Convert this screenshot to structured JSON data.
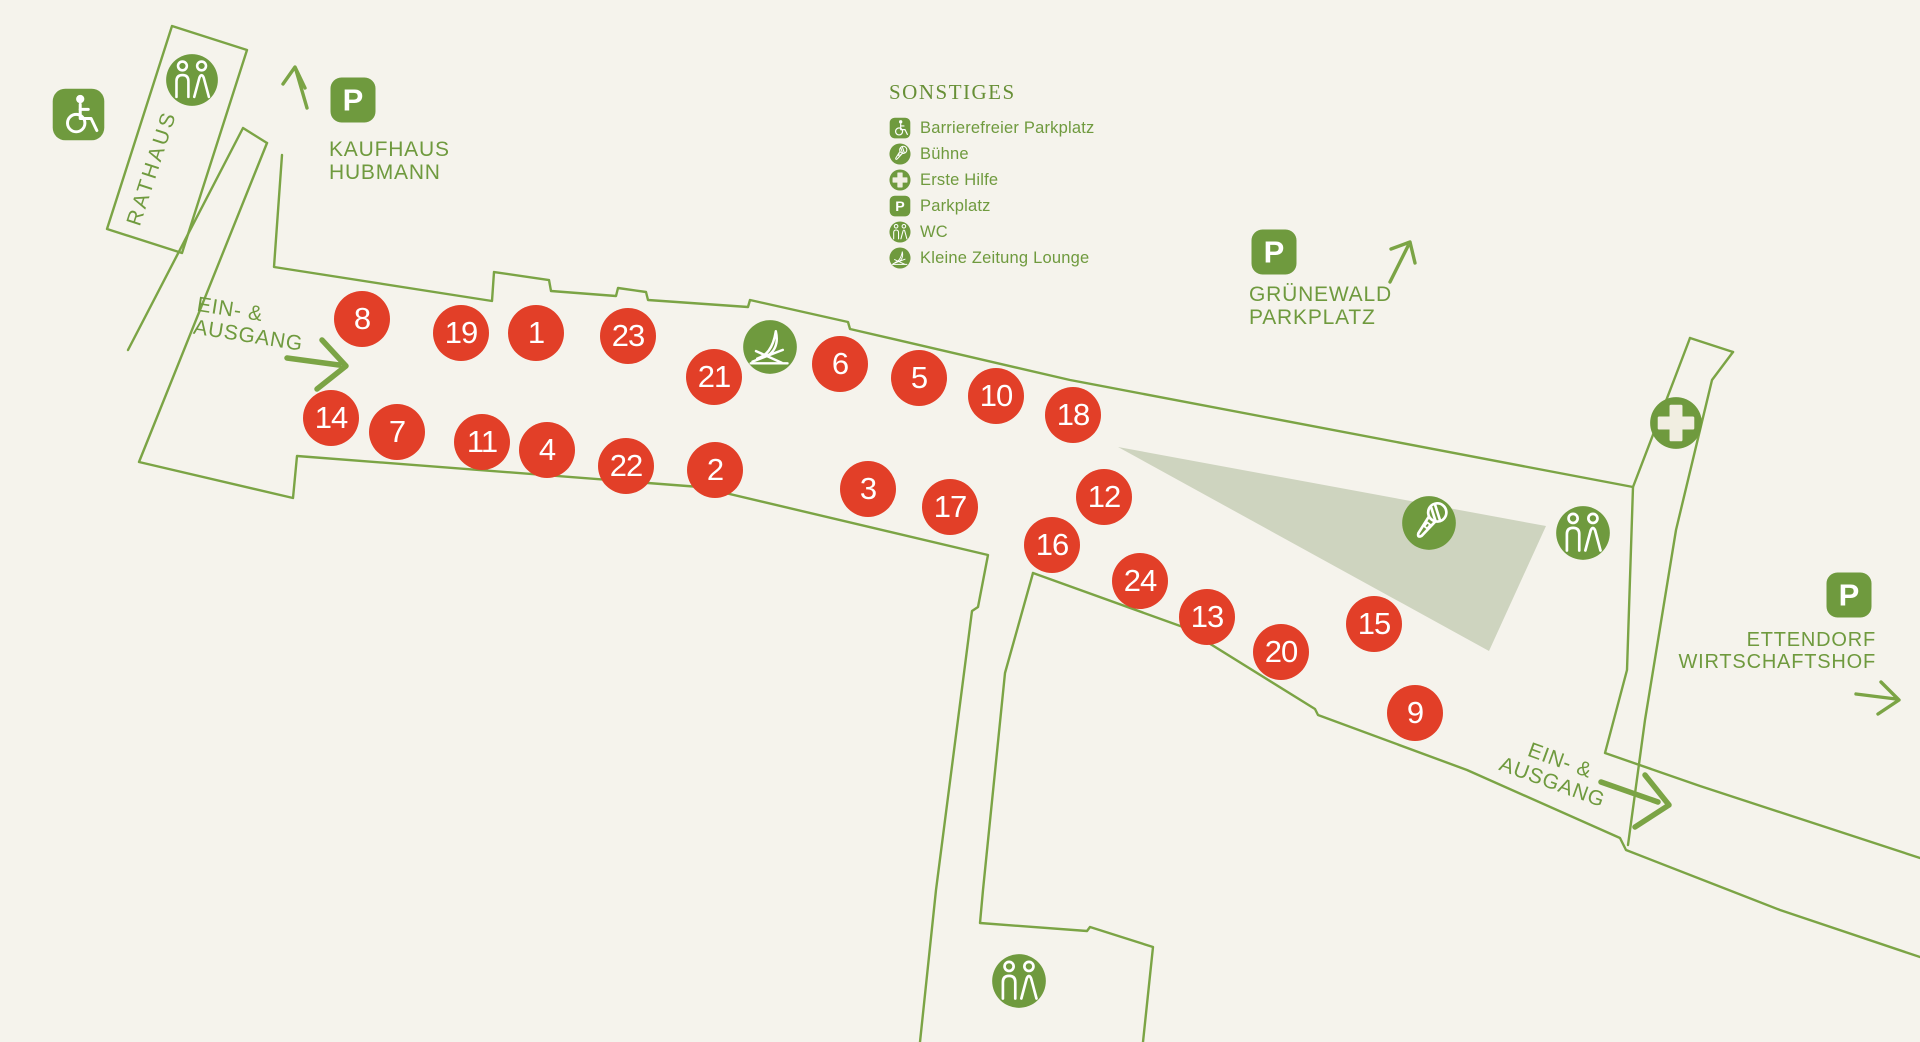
{
  "legend": {
    "title": "SONSTIGES",
    "items": [
      {
        "icon": "wheelchair",
        "label": "Barrierefreier Parkplatz"
      },
      {
        "icon": "mic",
        "label": "Bühne"
      },
      {
        "icon": "firstaid",
        "label": "Erste Hilfe"
      },
      {
        "icon": "parking",
        "label": "Parkplatz"
      },
      {
        "icon": "wc",
        "label": "WC"
      },
      {
        "icon": "lounge",
        "label": "Kleine Zeitung Lounge"
      }
    ]
  },
  "labels": {
    "rathaus": "RATHAUS",
    "kaufhaus_line1": "KAUFHAUS",
    "kaufhaus_line2": "HUBMANN",
    "gruenewald_line1": "GRÜNEWALD",
    "gruenewald_line2": "PARKPLATZ",
    "ettendorf_line1": "ETTENDORF",
    "ettendorf_line2": "WIRTSCHAFTSHOF",
    "entrance_west_line1": "EIN- &",
    "entrance_west_line2": "AUSGANG",
    "entrance_east_line1": "EIN- &",
    "entrance_east_line2": "AUSGANG"
  },
  "stalls": [
    {
      "number": "8",
      "x": 362,
      "y": 319
    },
    {
      "number": "19",
      "x": 461,
      "y": 333
    },
    {
      "number": "1",
      "x": 536,
      "y": 333
    },
    {
      "number": "23",
      "x": 628,
      "y": 336
    },
    {
      "number": "21",
      "x": 714,
      "y": 377
    },
    {
      "number": "6",
      "x": 840,
      "y": 364
    },
    {
      "number": "5",
      "x": 919,
      "y": 378
    },
    {
      "number": "10",
      "x": 996,
      "y": 396
    },
    {
      "number": "18",
      "x": 1073,
      "y": 415
    },
    {
      "number": "14",
      "x": 331,
      "y": 418
    },
    {
      "number": "7",
      "x": 397,
      "y": 432
    },
    {
      "number": "11",
      "x": 482,
      "y": 442
    },
    {
      "number": "4",
      "x": 547,
      "y": 450
    },
    {
      "number": "22",
      "x": 626,
      "y": 466
    },
    {
      "number": "2",
      "x": 715,
      "y": 470
    },
    {
      "number": "3",
      "x": 868,
      "y": 489
    },
    {
      "number": "17",
      "x": 950,
      "y": 507
    },
    {
      "number": "12",
      "x": 1104,
      "y": 497
    },
    {
      "number": "16",
      "x": 1052,
      "y": 545
    },
    {
      "number": "24",
      "x": 1140,
      "y": 581
    },
    {
      "number": "13",
      "x": 1207,
      "y": 617
    },
    {
      "number": "20",
      "x": 1281,
      "y": 652
    },
    {
      "number": "15",
      "x": 1374,
      "y": 624
    },
    {
      "number": "9",
      "x": 1415,
      "y": 713
    }
  ],
  "map_icons": [
    {
      "icon": "wheelchair",
      "x": 78,
      "y": 114,
      "size": 55,
      "shape": "square"
    },
    {
      "icon": "wc",
      "x": 192,
      "y": 80,
      "size": 54,
      "shape": "circle"
    },
    {
      "icon": "parking",
      "x": 353,
      "y": 100,
      "size": 48,
      "shape": "square"
    },
    {
      "icon": "parking",
      "x": 1274,
      "y": 252,
      "size": 48,
      "shape": "square"
    },
    {
      "icon": "parking",
      "x": 1849,
      "y": 595,
      "size": 48,
      "shape": "square"
    },
    {
      "icon": "lounge",
      "x": 770,
      "y": 347,
      "size": 56,
      "shape": "circle"
    },
    {
      "icon": "mic",
      "x": 1429,
      "y": 523,
      "size": 56,
      "shape": "circle"
    },
    {
      "icon": "wc",
      "x": 1583,
      "y": 533,
      "size": 56,
      "shape": "circle"
    },
    {
      "icon": "firstaid",
      "x": 1676,
      "y": 423,
      "size": 54,
      "shape": "circle"
    },
    {
      "icon": "wc",
      "x": 1019,
      "y": 981,
      "size": 56,
      "shape": "circle"
    }
  ],
  "colors": {
    "background": "#f5f3ec",
    "outline_green": "#7ba445",
    "icon_green": "#6f9a3e",
    "text_green": "#6f9a3e",
    "stall_red": "#e23f28",
    "stage_fill": "#ced4bf",
    "cream": "#f1eee1"
  }
}
